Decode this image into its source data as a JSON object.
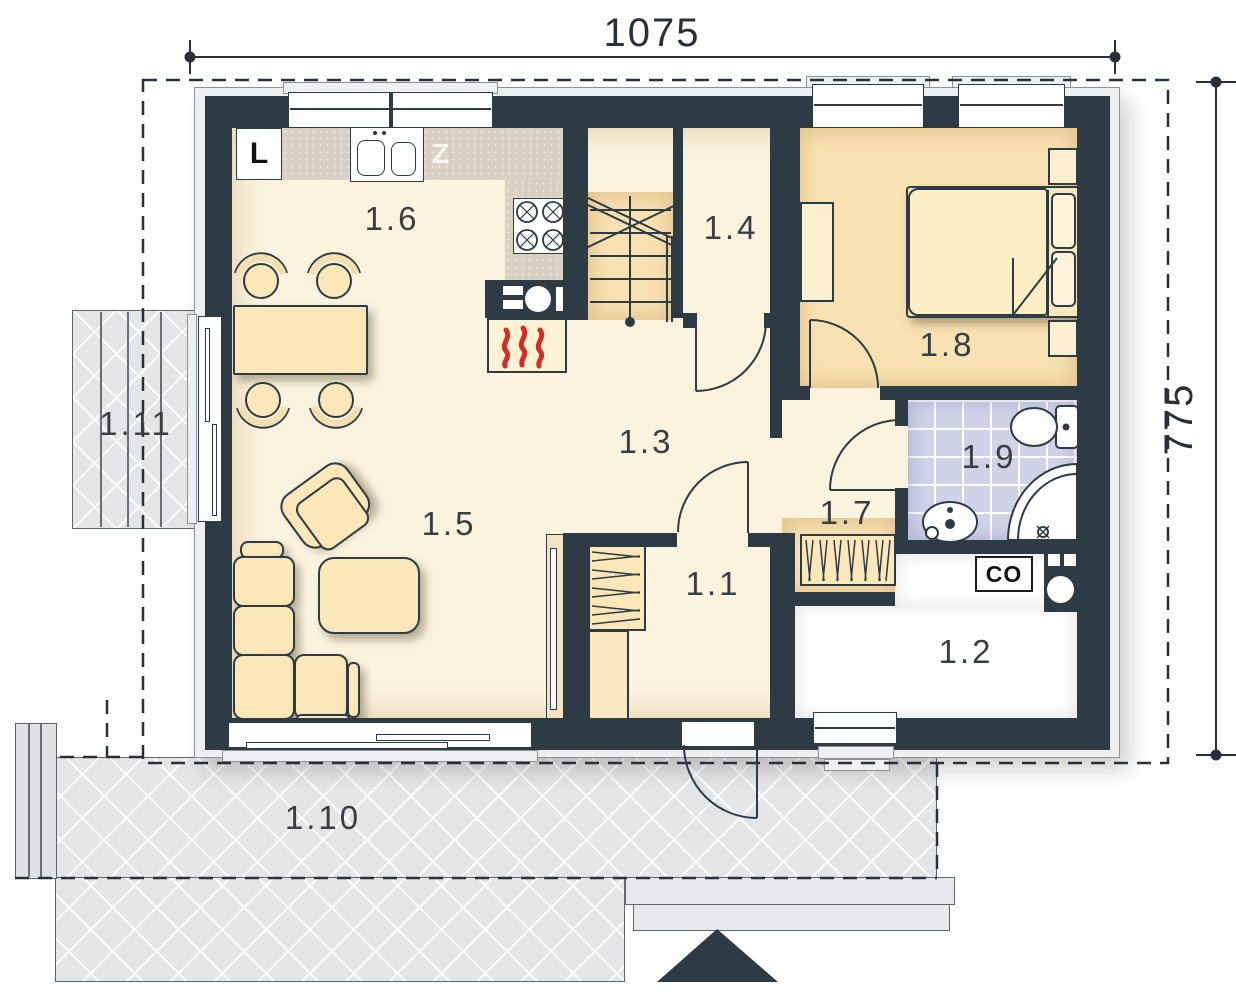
{
  "plan": {
    "type": "floor-plan",
    "floor": "ground"
  },
  "dimensions": {
    "top": "1075",
    "right": "775"
  },
  "rooms": [
    {
      "id": "1.1",
      "label": "1.1"
    },
    {
      "id": "1.2",
      "label": "1.2"
    },
    {
      "id": "1.3",
      "label": "1.3"
    },
    {
      "id": "1.4",
      "label": "1.4"
    },
    {
      "id": "1.5",
      "label": "1.5"
    },
    {
      "id": "1.6",
      "label": "1.6"
    },
    {
      "id": "1.7",
      "label": "1.7"
    },
    {
      "id": "1.8",
      "label": "1.8"
    },
    {
      "id": "1.9",
      "label": "1.9"
    },
    {
      "id": "1.10",
      "label": "1.10"
    },
    {
      "id": "1.11",
      "label": "1.11"
    }
  ],
  "kitchen": {
    "fridge_label": "L",
    "dishwasher_label": "Z"
  },
  "utility": {
    "boiler_label": "CO"
  },
  "colors": {
    "wall": "#2d3b44",
    "floor_cream": "#fbf3de",
    "floor_peach": "#f9e2b2",
    "bath_tile": "#ced3e8",
    "counter": "#d9d2c4",
    "furniture": "#fbe7b8",
    "terrace": "#e3e5e7",
    "flame_red": "#d22d26"
  }
}
